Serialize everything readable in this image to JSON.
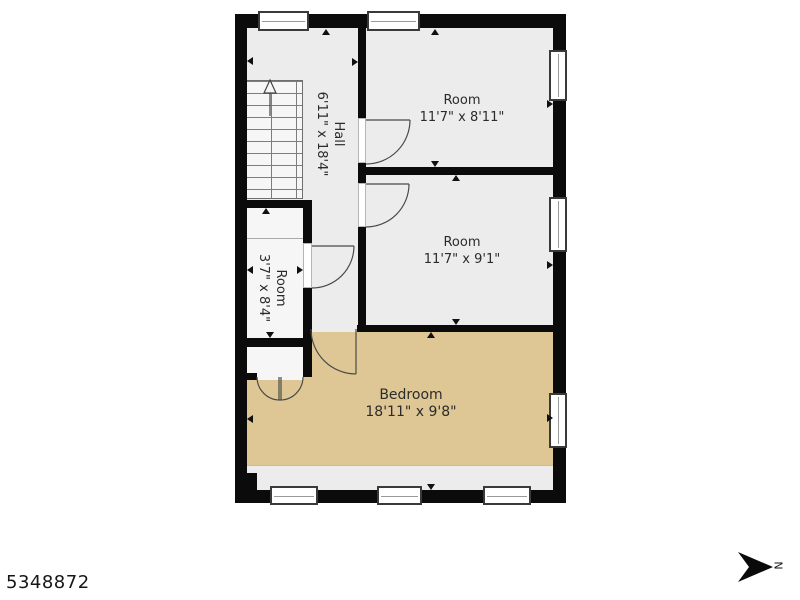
{
  "listing_id": "5348872",
  "compass": {
    "label": "N",
    "points": "right"
  },
  "floor_plan": {
    "rooms": [
      {
        "id": "hall",
        "name": "Hall",
        "dimensions": "6'11\" x 18'4\"",
        "text_orientation": "vertical"
      },
      {
        "id": "room-top-right",
        "name": "Room",
        "dimensions": "11'7\" x 8'11\"",
        "text_orientation": "horizontal"
      },
      {
        "id": "room-middle-right",
        "name": "Room",
        "dimensions": "11'7\" x 9'1\"",
        "text_orientation": "horizontal"
      },
      {
        "id": "room-left",
        "name": "Room",
        "dimensions": "3'7\" x 8'4\"",
        "text_orientation": "vertical"
      },
      {
        "id": "bedroom",
        "name": "Bedroom",
        "dimensions": "18'11\" x 9'8\"",
        "text_orientation": "horizontal"
      }
    ],
    "staircase": {
      "direction_arrow": "up"
    },
    "window_count": 8,
    "door_count": 6
  },
  "colors": {
    "wall": "#0b0b0b",
    "room_floor": "#ececec",
    "light_floor": "#f6f6f6",
    "bedroom_floor": "#dec795",
    "background": "#ffffff",
    "line": "#4a4a4a",
    "text": "#2b2b2b"
  }
}
